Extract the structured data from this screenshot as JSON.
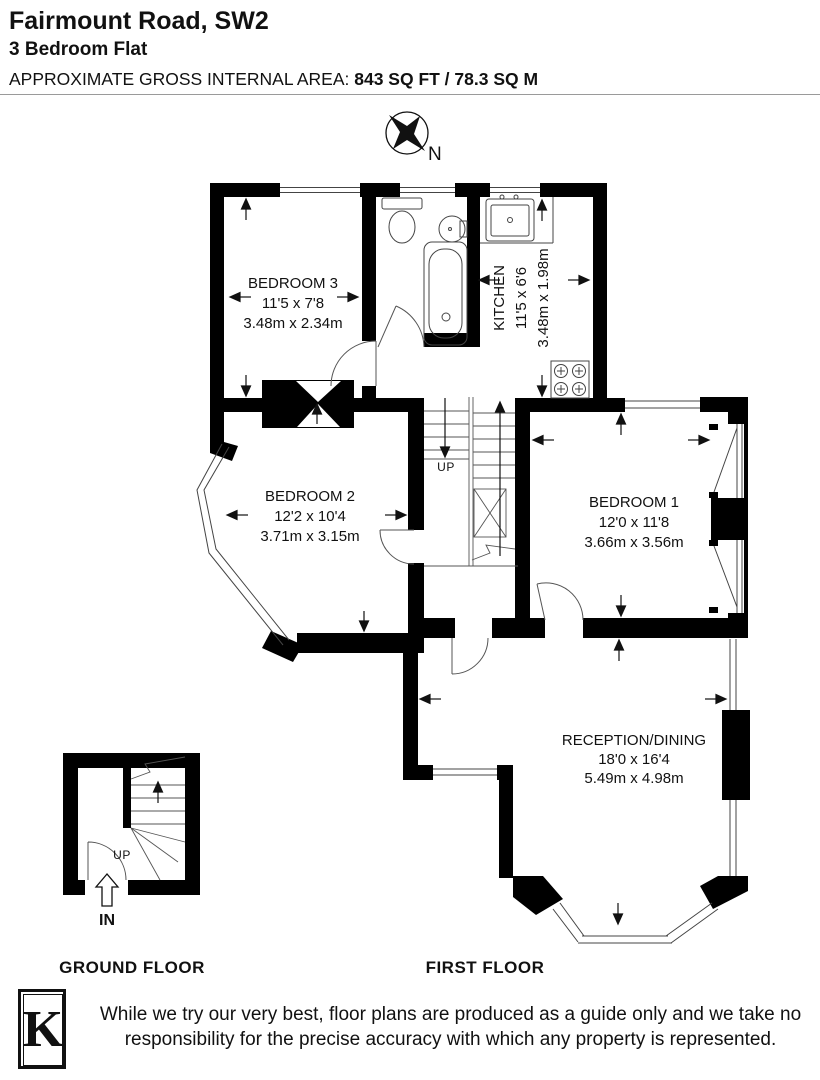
{
  "header": {
    "title": "Fairmount Road, SW2",
    "subtitle": "3 Bedroom Flat",
    "area_label": "APPROXIMATE GROSS INTERNAL AREA:",
    "area_value": "843 SQ FT / 78.3 SQ M"
  },
  "compass": {
    "north_label": "N"
  },
  "floor_plan": {
    "first_floor": {
      "label": "FIRST FLOOR",
      "stairs_label": "UP",
      "rooms": [
        {
          "name": "BEDROOM 3",
          "imperial": "11'5 x 7'8",
          "metric": "3.48m x 2.34m"
        },
        {
          "name": "KITCHEN",
          "imperial": "11'5 x 6'6",
          "metric": "3.48m x 1.98m"
        },
        {
          "name": "BEDROOM 2",
          "imperial": "12'2 x 10'4",
          "metric": "3.71m x 3.15m"
        },
        {
          "name": "BEDROOM 1",
          "imperial": "12'0 x 11'8",
          "metric": "3.66m x 3.56m"
        },
        {
          "name": "RECEPTION/DINING",
          "imperial": "18'0 x 16'4",
          "metric": "5.49m x 4.98m"
        }
      ]
    },
    "ground_floor": {
      "label": "GROUND FLOOR",
      "stairs_label": "UP",
      "entrance_label": "IN"
    }
  },
  "footer": {
    "logo_letter": "K",
    "disclaimer": "While we try our very best, floor plans are produced as a guide only and we take no responsibility for the precise accuracy with which any property is represented."
  },
  "colors": {
    "wall": "#000000",
    "line": "#444444",
    "text": "#111111"
  }
}
